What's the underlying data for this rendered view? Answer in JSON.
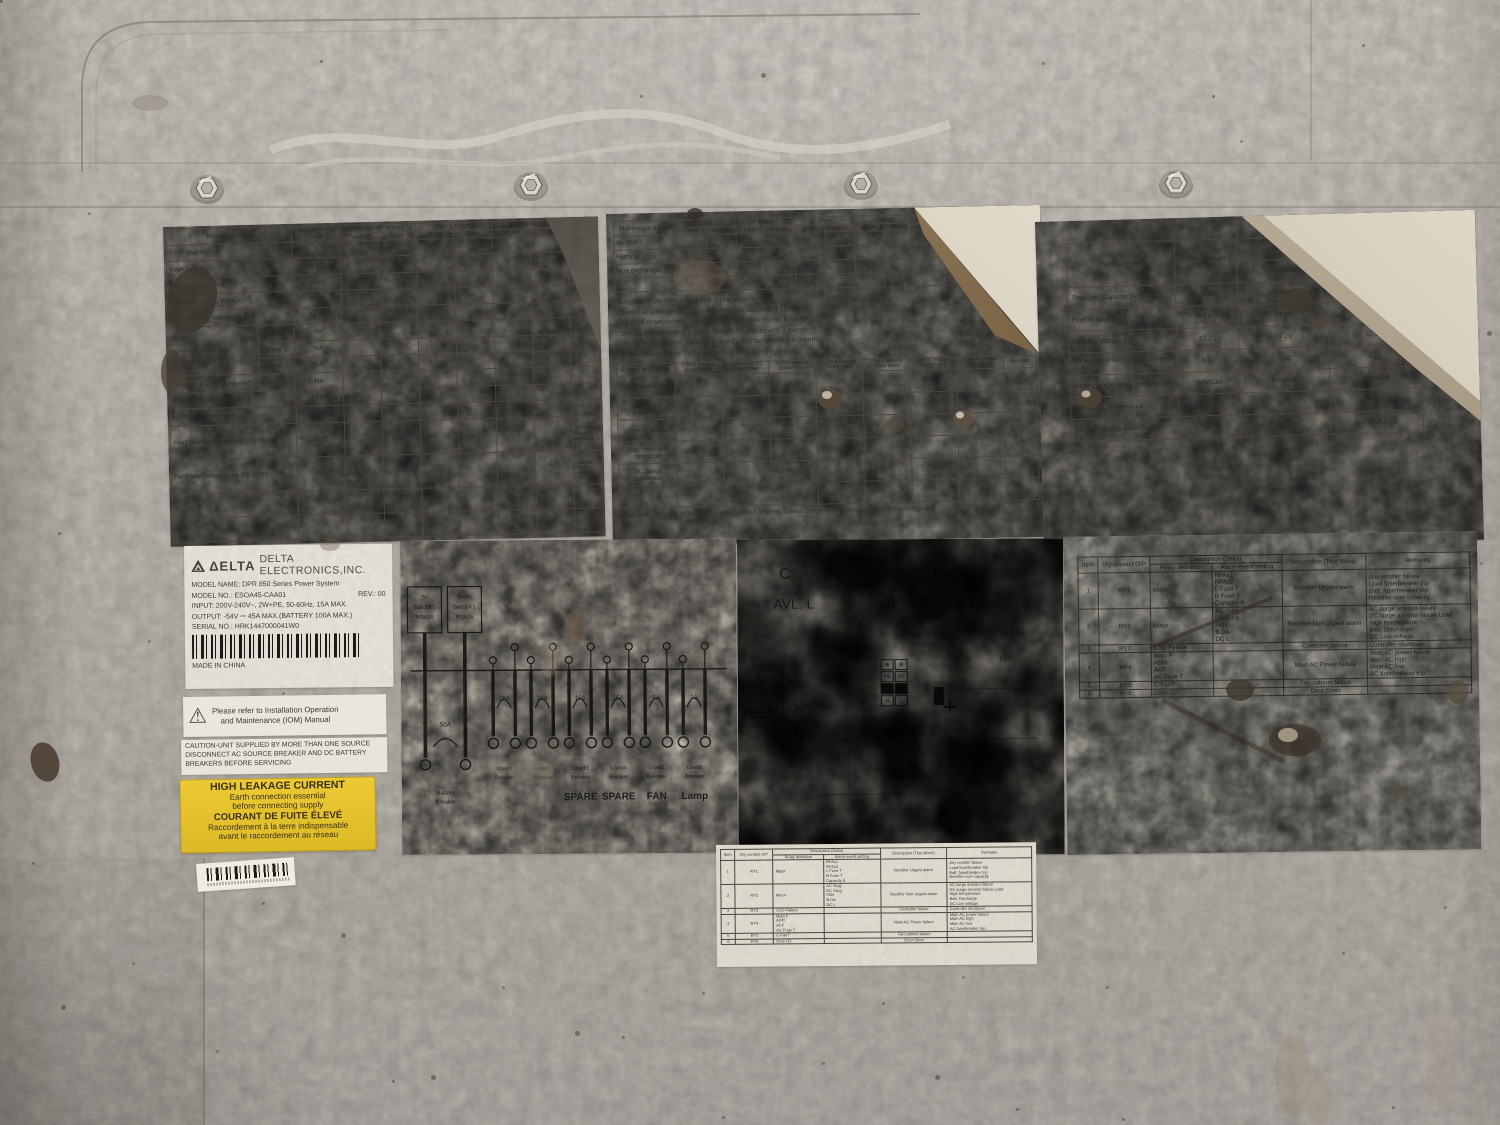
{
  "photo": {
    "panel_color": "#c0bbb4",
    "label_metal_color": "#a5a198",
    "label_paper_color": "#d8d2c6",
    "warning_yellow": "#e3c12d",
    "ink": "#2b2a24"
  },
  "param_label": {
    "header": {
      "item": "Item parameter",
      "default_setting": "Default setting value",
      "install": "Installation setting",
      "user1": "User's setting",
      "user2": "User's setting",
      "value": "Value",
      "date": "Date",
      "remark": "Remark"
    },
    "rows": [
      {
        "name": "SWR Quantity",
        "value": "3"
      },
      {
        "name": "SWR M/N",
        "value": "DPR 850-B"
      },
      {
        "name": "Batt. Capacity (AH)",
        "value": "50AH"
      },
      {
        "name": "Float Voltage (FL Voltage)(V)",
        "value": "54.0V"
      },
      {
        "name": "Equalize (EQ) Voltage(V)",
        "value": "57.2V"
      },
      {
        "name": "EQ current limit (0.X C)",
        "sub": "Stage 1",
        "value": "5A",
        "group": 3
      },
      {
        "sub": "Stage 2",
        "value": "NA"
      },
      {
        "sub": "Stage 3",
        "value": "NA"
      },
      {
        "name": "Load LVD(LLVD) Voltage(V)",
        "value": "NA"
      },
      {
        "name": "Batt.LVD(BLVD) Voltage(V)",
        "value": "43.0V"
      },
      {
        "name": "Humidity sensor (%)",
        "value": "NA"
      },
      {
        "name": "Fan1 start temperature (°C or °F)",
        "value": "35°C",
        "remark": "□Fan tray\n□heat exchange"
      },
      {
        "name": "Fan2 start temperature (°C or °F)",
        "value": "NA",
        "remark": "□Fan tray\n□heat exchange"
      },
      {
        "name": "",
        "value": ""
      },
      {
        "name": "",
        "value": ""
      }
    ]
  },
  "maint_label": {
    "table1": {
      "item_header": "Maintenance Item",
      "date": "Date",
      "clean": "Clean",
      "replace": "Replace",
      "cols": 6,
      "rows": [
        "Air filter",
        "Fan tray",
        "heat exchanger",
        ""
      ]
    },
    "suggestion": [
      "Suggestion air filter clean and replace cycle",
      "□Better environment, clean 4 month, Replacement 12 month.",
      "□Normal environment, clean 2 month, Replacement 6 month.",
      "□Worse environment, clean 1 month, Replacement 3 month.",
      "□Worst environment, clean 0.5 month, Replacement 1.5 month.",
      "Please select above cycle according to real environment."
    ],
    "table2": {
      "item_header": "Examination Item",
      "check": "Check Record",
      "datetime": "(Date/Time)",
      "remark": "Remark",
      "cols": 7,
      "rows": [
        "Date and Time",
        "AC Surge protection",
        "Battery health",
        "Batt. Inter cell connector",
        "DC Surge protection",
        ""
      ]
    },
    "footer": "Suggestion! In order to let system work without any risk, please check above items and fill this form regularly."
  },
  "battery_label": {
    "header": {
      "items": "Setting Items",
      "factory": "Factory default setting",
      "recommended": "Recommended Battery relative settings",
      "b50": "50AH Battery",
      "b100": "100AH Battery"
    },
    "rows": [
      {
        "name": "Total Batt. Capacity (AH)",
        "factory": "50AH",
        "b50": "50AH",
        "b100": "100AH"
      },
      {
        "name": "Float Voltage (V)",
        "factory": "54.0V",
        "b50": "54.0V",
        "b100": "54.0V"
      },
      {
        "name": "Equalize Voltage (V)",
        "factory": "57.2V",
        "b50": "57.2V",
        "b100": "57.2V"
      },
      {
        "name": "Battery maximum charge current (0.X C)",
        "factory": "0.1C",
        "b50": "0.1C",
        "b100": "0.1C"
      },
      {
        "name": "Battery temperature compensation",
        "factory": "3mV/Cell",
        "b50": "3mV/Cell",
        "b100": "3mV/Cell"
      },
      {
        "name": "Reference Temperature",
        "factory": "25°C",
        "b50": "25°C",
        "b100": "25°C"
      },
      {
        "name": "DC high voltage alarm (DCH)",
        "factory": "58.0V",
        "b50": "58.0V",
        "b100": "58.0V"
      }
    ],
    "side_note": "50AH/100AH battery setting is according to Gencais TD Battery 12TD series specifications"
  },
  "delta_label": {
    "brand": "ΔELTA",
    "company": "DELTA ELECTRONICS,INC.",
    "model_name": "MODEL NAME: DPR 850 Series Power System",
    "model_no": "MODEL NO.: ESOA45-CAA01",
    "rev": "REV.: 00",
    "input": "INPUT: 200V-240V~, 2W+PE, 50-60Hz, 15A MAX.",
    "output": "OUTPUT: -54V ⎓ 45A MAX.(BATTERY 100A MAX.)",
    "serial": "SERIAL NO.: HRK1447000041W0",
    "made_in": "MADE IN CHINA"
  },
  "iom_label": {
    "icon": "⚠",
    "line1": "Please refer to Installation Operation",
    "line2": "and Maintenance (IOM) Manual"
  },
  "caution_label": {
    "line1": "CAUTION-UNIT SUPPLIED BY MORE THAN ONE SOURCE",
    "line2": "DISCONNECT AC SOURCE BREAKER AND DC BATTERY",
    "line3": "BREAKERS BEFORE SERVICING"
  },
  "leakage_label": {
    "lines": [
      "HIGH LEAKAGE CURRENT",
      "Earth connection essential",
      "before connecting supply",
      "COURANT DE FUITE ÉLEVÉ",
      "Raccordement à la terre indispensable",
      "avant le raccordement au réseau"
    ]
  },
  "breaker_label": {
    "box1": "To\nBatt.BK1\nPOA16",
    "box2": "From\nBatt.BK1\nPOA16",
    "battery": {
      "amp": "50A",
      "name1": "Battery",
      "name2": "Breaker"
    },
    "loads": [
      {
        "amp": "16A",
        "name1": "Load1",
        "name2": "Breaker",
        "tag": ""
      },
      {
        "amp": "16A",
        "name1": "Load2",
        "name2": "Breaker",
        "tag": ""
      },
      {
        "amp": "16A",
        "name1": "Load3",
        "name2": "Breaker",
        "tag": "SPARE"
      },
      {
        "amp": "16A",
        "name1": "Load4",
        "name2": "Breaker",
        "tag": "SPARE"
      },
      {
        "amp": "6A",
        "name1": "Load5",
        "name2": "Breaker",
        "tag": "FAN"
      },
      {
        "amp": "1A",
        "name1": "Load6",
        "name2": "Breaker",
        "tag": "Lamp"
      }
    ]
  },
  "wiring_label": {
    "fragments": [
      "C",
      "ut",
      "AVL. L",
      "0",
      "8D",
      "#2(AWG)",
      "#6(AWG)",
      "AUX TB",
      "FUSE"
    ],
    "fan_glyph1": "⊗",
    "fan_glyph2": "⊗",
    "terminals": [
      "PE",
      "PE",
      "N",
      "L"
    ]
  },
  "dry_contact": {
    "header": {
      "item": "Item",
      "op": "Dry contact O/P",
      "desc_delta": "Description (Delta)",
      "relay": "Relay definition",
      "alarm": "Alarm event setting",
      "desc_tm": "Description (True Move)",
      "remarks": "Remarks"
    },
    "rows": [
      {
        "item": "1",
        "op": "RY1",
        "relay": "Major",
        "alarm": "RFAx1\nRFAx2\nL Fuse T\nB Fuse T\nCapacity A",
        "desc": "Rectifier Urgent alarm",
        "remarks": "Any rectifier failure\nLoad fuse/breaker trip\nBatt. fuse/breaker trip\nRectifier over capacity"
      },
      {
        "item": "2",
        "op": "RY2",
        "relay": "Minor",
        "alarm": "AC Surg\nDC Surg\nFAN\nB.Dis\nDC L",
        "desc": "Rectifier Non Urgent alarm",
        "remarks": "AC surge arrestor failure\nDC surge arrestor failure Load\nHigh temperature\nBatt. Discharge\nDC Low voltage"
      },
      {
        "item": "3",
        "op": "RY3",
        "relay": "CSU Failure",
        "alarm": "",
        "desc": "Controller failure",
        "remarks": "Controller shutdown"
      },
      {
        "item": "4",
        "op": "RY4",
        "relay": "Main F\nADH\nACF\nAC Fuse T",
        "alarm": "",
        "desc": "Main AC Power failure",
        "remarks": "Main AC power failure\nMain AC high\nMain AC low\nAC fuse/breaker trip"
      },
      {
        "item": "5",
        "op": "RY5",
        "relay": "C-FanT",
        "alarm": "",
        "desc": "Fan cabinet failure",
        "remarks": ""
      },
      {
        "item": "6",
        "op": "RY6",
        "relay": "Door O2",
        "alarm": "",
        "desc": "Door Open",
        "remarks": ""
      }
    ]
  }
}
